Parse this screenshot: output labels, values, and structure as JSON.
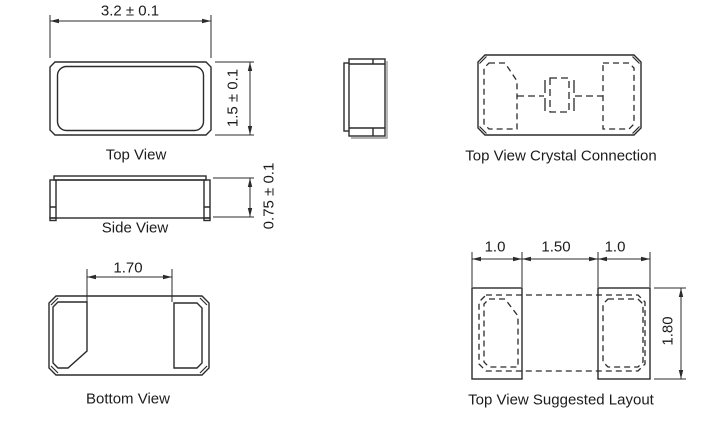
{
  "figures": {
    "top_view": {
      "label": "Top View",
      "dim_width": "3.2 ± 0.1",
      "dim_height": "1.5 ± 0.1"
    },
    "side_view": {
      "label": "Side View",
      "dim_height": "0.75 ± 0.1"
    },
    "bottom_view": {
      "label": "Bottom View",
      "dim_pad_spacing": "1.70"
    },
    "crystal_connection": {
      "label": "Top View Crystal Connection"
    },
    "suggested_layout": {
      "label": "Top View Suggested Layout",
      "dim_left_pad": "1.0",
      "dim_gap": "1.50",
      "dim_right_pad": "1.0",
      "dim_height": "1.80"
    }
  },
  "colors": {
    "line": "#2b2b2b",
    "shadow": "#9a9a9a",
    "background": "#ffffff"
  }
}
